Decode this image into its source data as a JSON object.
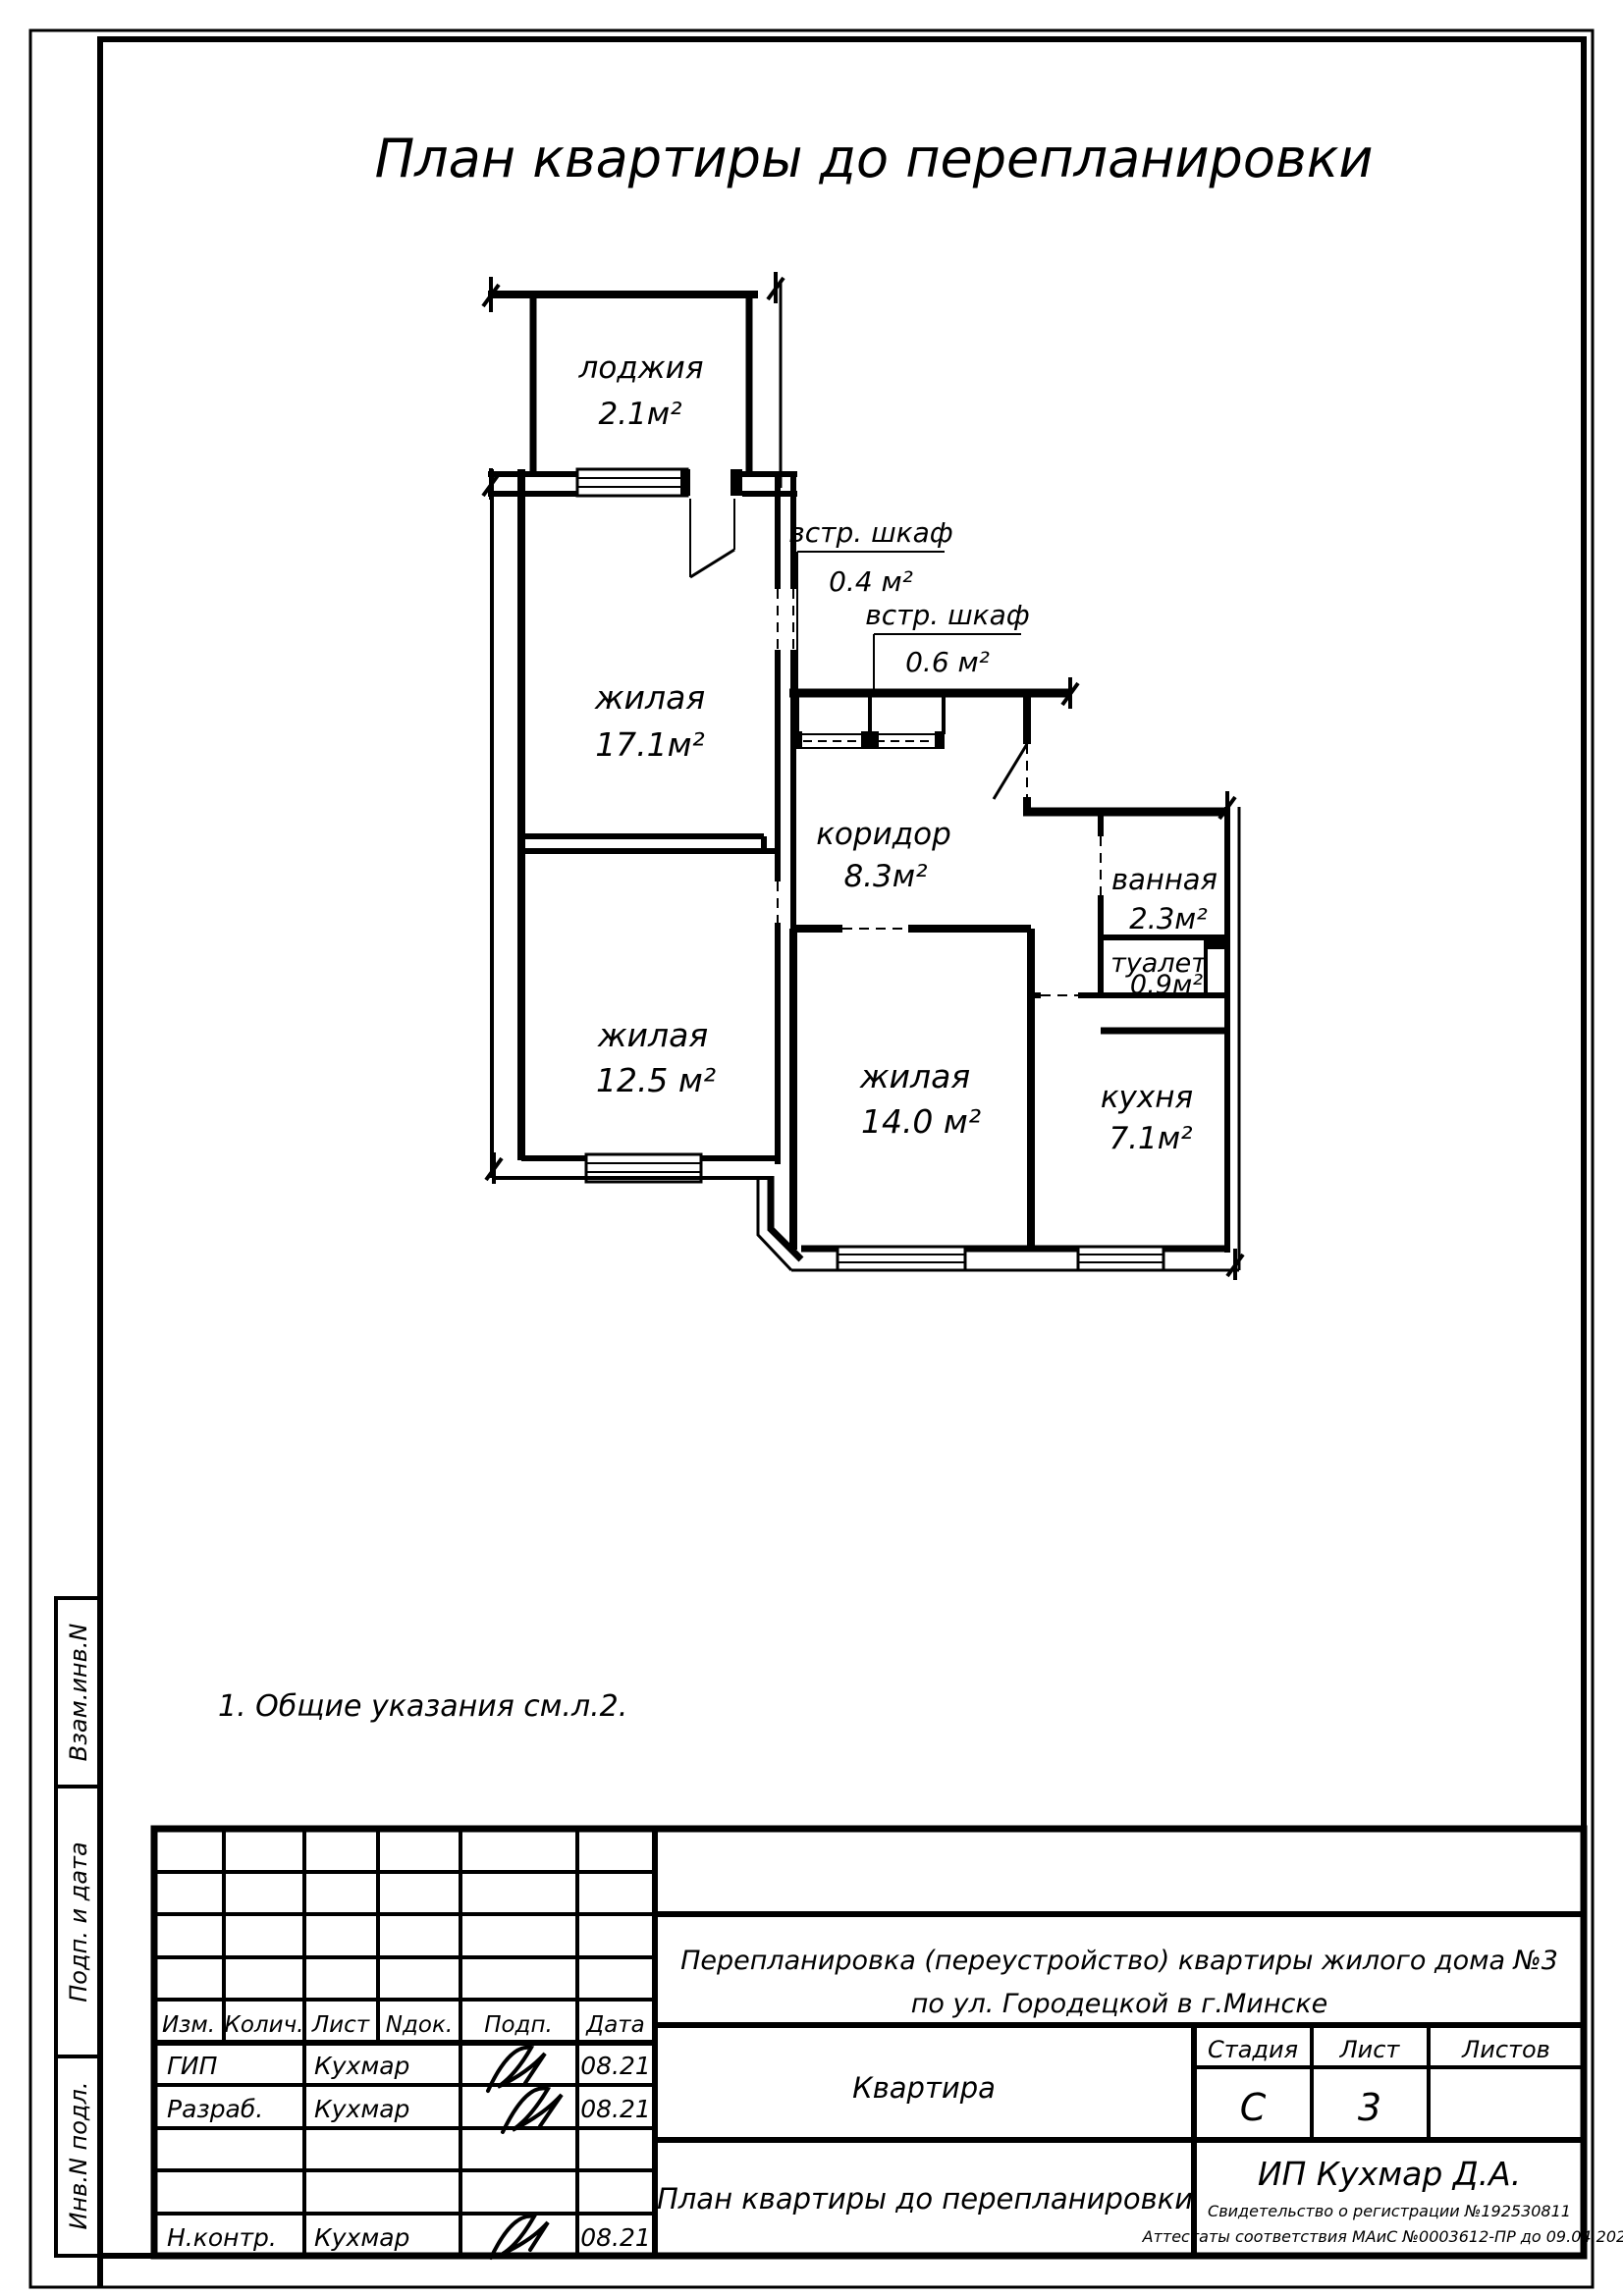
{
  "page": {
    "title_text": "План квартиры до перепланировки",
    "note": "1.  Общие указания см.л.2."
  },
  "plan": {
    "loggia": {
      "name": "лоджия",
      "area": "2.1м²"
    },
    "living1": {
      "name": "жилая",
      "area": "17.1м²"
    },
    "closet1": {
      "name": "встр. шкаф",
      "area": "0.4 м²"
    },
    "closet2": {
      "name": "встр. шкаф",
      "area": "0.6 м²"
    },
    "corridor": {
      "name": "коридор",
      "area": "8.3м²"
    },
    "living2": {
      "name": "жилая",
      "area": "12.5 м²"
    },
    "living3": {
      "name": "жилая",
      "area": "14.0 м²"
    },
    "bath": {
      "name": "ванная",
      "area": "2.3м²"
    },
    "wc": {
      "name": "туалет",
      "area": "0.9м²"
    },
    "kitchen": {
      "name": "кухня",
      "area": "7.1м²"
    }
  },
  "titleblock": {
    "cols": {
      "izm": "Изм.",
      "kol": "Колич.",
      "list": "Лист",
      "ndok": "Nдок.",
      "podp": "Подп.",
      "data": "Дата"
    },
    "rows": {
      "gip": {
        "role": "ГИП",
        "name": "Кухмар",
        "date": "08.21"
      },
      "razrab": {
        "role": "Разраб.",
        "name": "Кухмар",
        "date": "08.21"
      },
      "nkontr": {
        "role": "Н.контр.",
        "name": "Кухмар",
        "date": "08.21"
      }
    },
    "project_line1": "Перепланировка (переустройство) квартиры жилого дома №3",
    "project_line2": "по ул. Городецкой в г.Минске",
    "object_name": "Квартира",
    "stage_label": "Стадия",
    "sheet_label": "Лист",
    "sheets_label": "Листов",
    "stage_value": "С",
    "sheet_value": "3",
    "doc_title": "План квартиры до перепланировки",
    "firm": "ИП Кухмар Д.А.",
    "cert1": "Свидетельство о регистрации №192530811",
    "cert2": "Аттестаты соответствия МАиС  №0003612-ПР  до  09.04.2026"
  },
  "margin": {
    "v1": "Взам.инв.N",
    "v2": "Подп. и дата",
    "v3": "Инв.N подл."
  },
  "colors": {
    "ink": "#000000",
    "paper": "#ffffff"
  }
}
